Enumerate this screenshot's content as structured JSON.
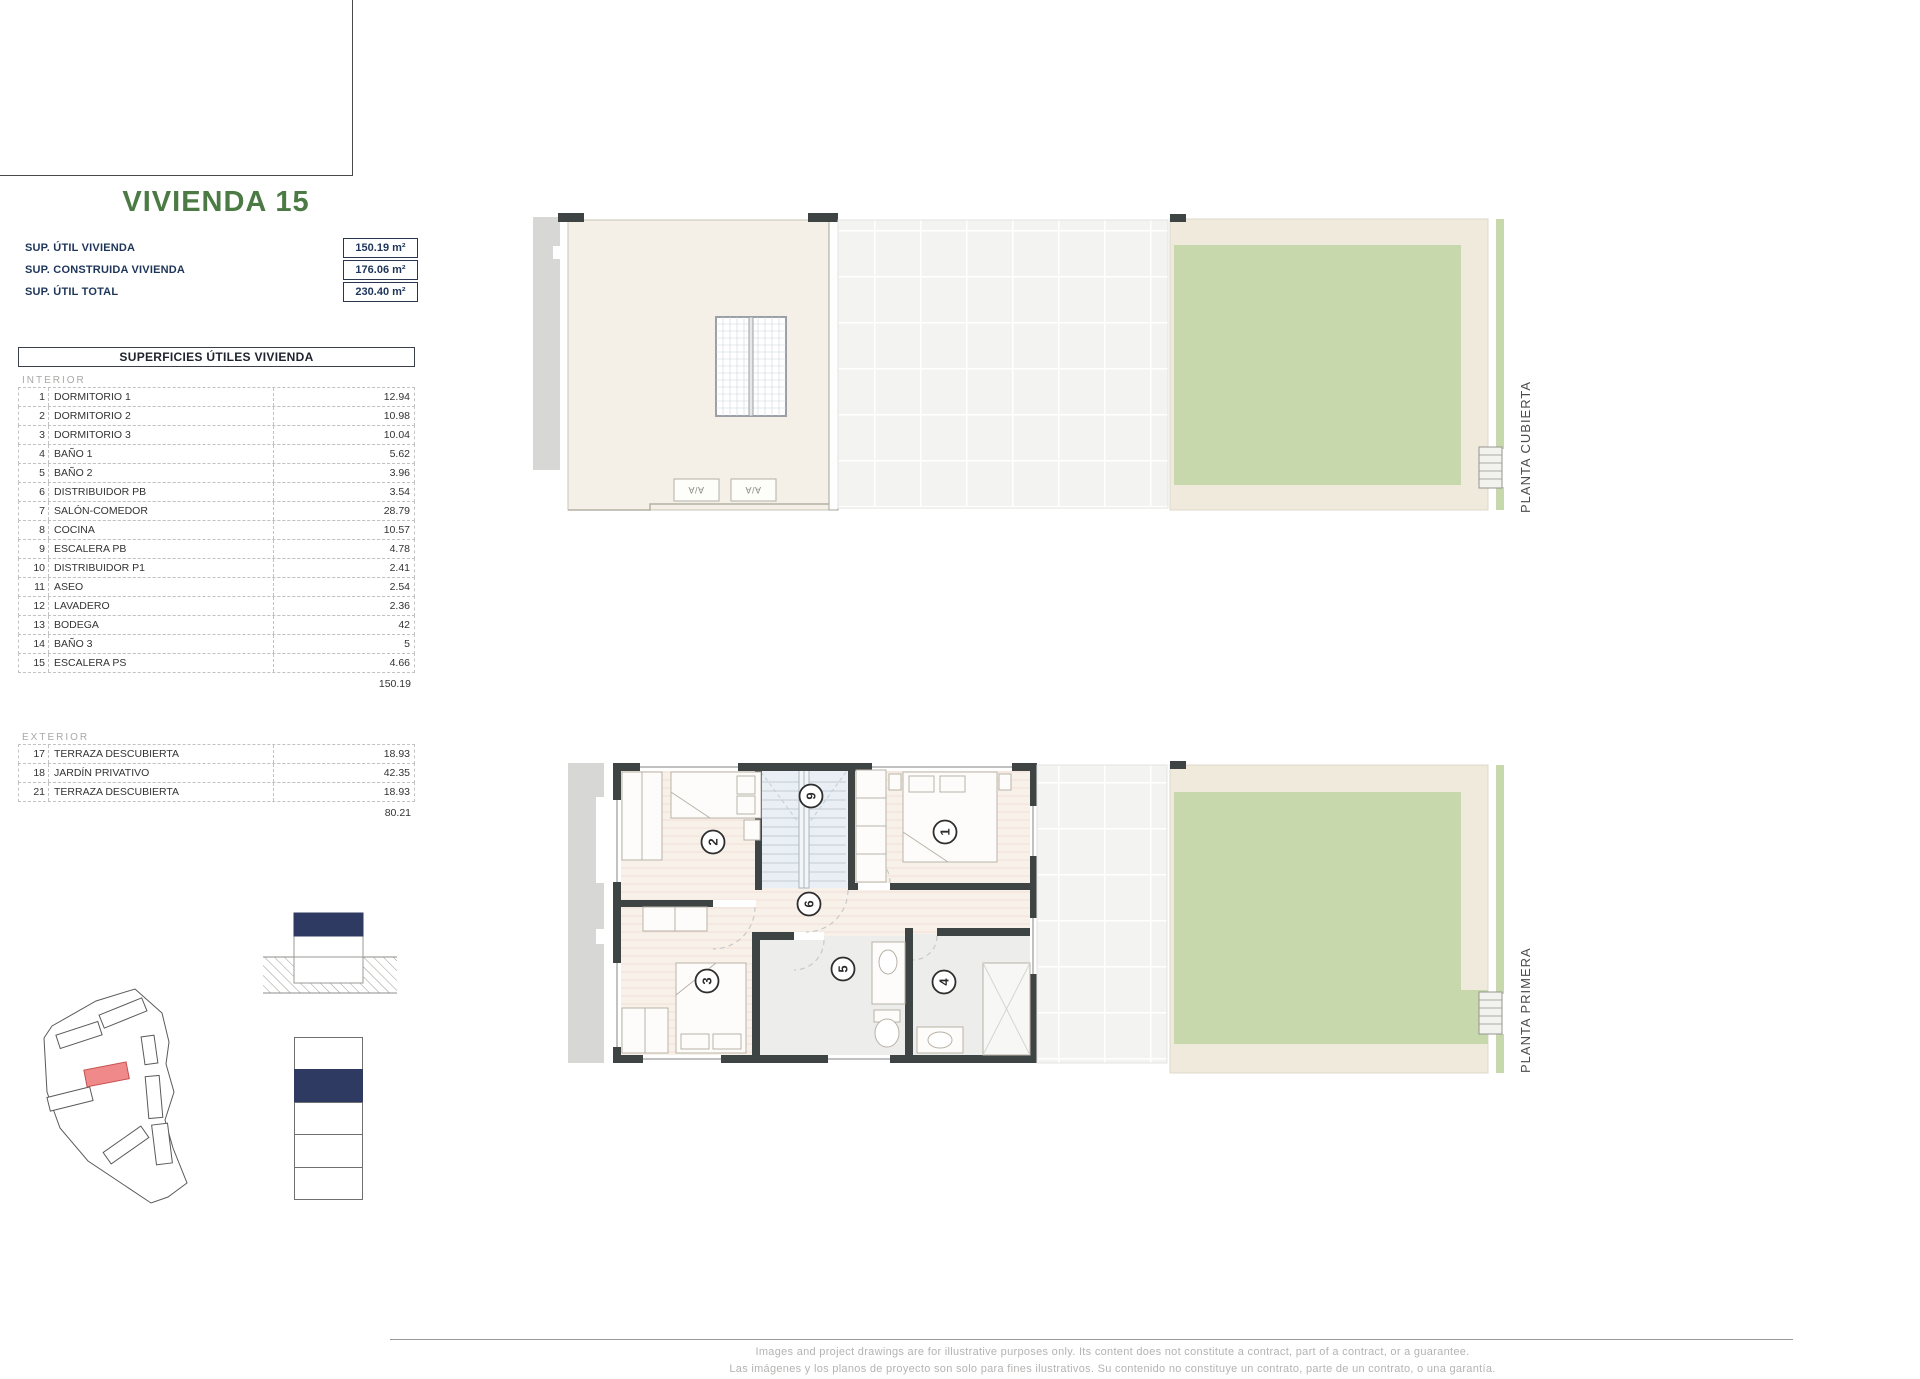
{
  "header": {
    "title": "VIVIENDA 15"
  },
  "summary": [
    {
      "label": "SUP. ÚTIL VIVIENDA",
      "value": "150.19 m²"
    },
    {
      "label": "SUP. CONSTRUIDA VIVIENDA",
      "value": "176.06 m²"
    },
    {
      "label": "SUP. ÚTIL TOTAL",
      "value": "230.40 m²"
    }
  ],
  "areas": {
    "header": "SUPERFICIES ÚTILES VIVIENDA",
    "interior_label": "INTERIOR",
    "interior_rows": [
      {
        "num": "1",
        "name": "DORMITORIO 1",
        "value": "12.94"
      },
      {
        "num": "2",
        "name": "DORMITORIO 2",
        "value": "10.98"
      },
      {
        "num": "3",
        "name": "DORMITORIO 3",
        "value": "10.04"
      },
      {
        "num": "4",
        "name": "BAÑO 1",
        "value": "5.62"
      },
      {
        "num": "5",
        "name": "BAÑO 2",
        "value": "3.96"
      },
      {
        "num": "6",
        "name": "DISTRIBUIDOR PB",
        "value": "3.54"
      },
      {
        "num": "7",
        "name": "SALÓN-COMEDOR",
        "value": "28.79"
      },
      {
        "num": "8",
        "name": "COCINA",
        "value": "10.57"
      },
      {
        "num": "9",
        "name": "ESCALERA PB",
        "value": "4.78"
      },
      {
        "num": "10",
        "name": "DISTRIBUIDOR P1",
        "value": "2.41"
      },
      {
        "num": "11",
        "name": "ASEO",
        "value": "2.54"
      },
      {
        "num": "12",
        "name": "LAVADERO",
        "value": "2.36"
      },
      {
        "num": "13",
        "name": "BODEGA",
        "value": "42"
      },
      {
        "num": "14",
        "name": "BAÑO 3",
        "value": "5"
      },
      {
        "num": "15",
        "name": "ESCALERA PS",
        "value": "4.66"
      }
    ],
    "interior_total": "150.19",
    "exterior_label": "EXTERIOR",
    "exterior_rows": [
      {
        "num": "17",
        "name": "TERRAZA DESCUBIERTA",
        "value": "18.93"
      },
      {
        "num": "18",
        "name": "JARDÍN PRIVATIVO",
        "value": "42.35"
      },
      {
        "num": "21",
        "name": "TERRAZA DESCUBIERTA",
        "value": "18.93"
      }
    ],
    "exterior_total": "80.21"
  },
  "plans": {
    "cubierta": {
      "label": "PLANTA CUBIERTA",
      "ac": [
        "A/A",
        "A/A"
      ]
    },
    "primera": {
      "label": "PLANTA PRIMERA",
      "rooms": {
        "r1": "1",
        "r2": "2",
        "r3": "3",
        "r4": "4",
        "r5": "5",
        "r6": "6",
        "r9": "9"
      }
    }
  },
  "footer": {
    "line1": "Images and project drawings are for illustrative purposes only. Its content does not constitute a contract, part of a contract, or a guarantee.",
    "line2": "Las imágenes y los planos de proyecto son solo para fines ilustrativos. Su contenido no constituye un contrato, parte de un contrato, o una garantía."
  },
  "colors": {
    "title_green": "#4c7a45",
    "navy_text": "#1e3559",
    "diagram_navy": "#2f3a62",
    "highlight_red": "#f08a8a",
    "garden_green": "#c8d8ad",
    "path_beige": "#efeadc",
    "wall_dark": "#3e4444"
  }
}
